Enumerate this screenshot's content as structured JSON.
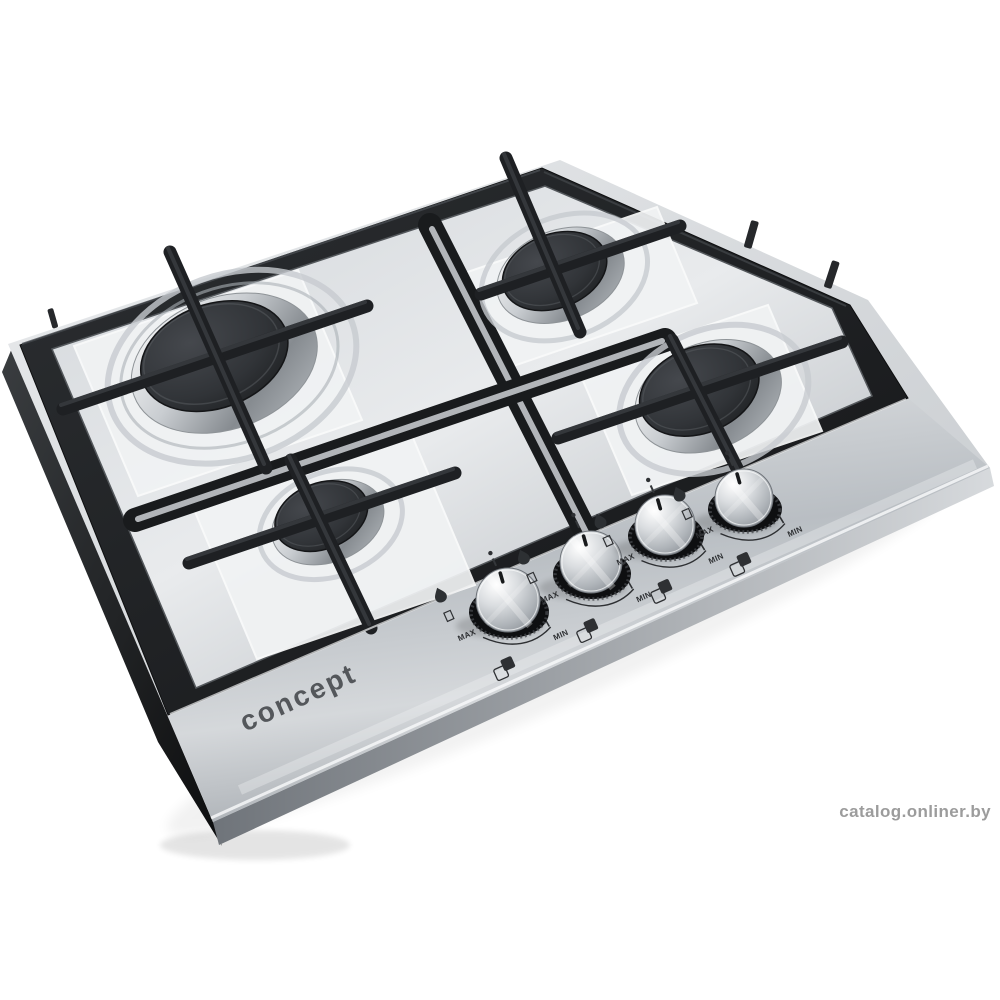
{
  "scene": {
    "background_color": "#ffffff",
    "subject": "Stainless steel four-burner gas hob with black cast-iron pan supports, matte black burner caps and four metal control knobs on the front panel"
  },
  "brand": {
    "logo_text": "concept",
    "logo_color": "#54575b"
  },
  "watermark": {
    "text": "catalog.onliner.by",
    "color": "#9c9c9c"
  },
  "controls": {
    "max_label": "MAX",
    "min_label": "MIN",
    "knobs": [
      {
        "name": "front-left burner knob"
      },
      {
        "name": "rear-left burner knob"
      },
      {
        "name": "rear-right burner knob"
      },
      {
        "name": "front-right burner knob"
      }
    ]
  },
  "burners": [
    {
      "position": "rear-left",
      "size": "large"
    },
    {
      "position": "rear-right",
      "size": "medium"
    },
    {
      "position": "front-right",
      "size": "medium"
    },
    {
      "position": "front-left",
      "size": "small"
    }
  ],
  "colors": {
    "steel_light": "#eef0f2",
    "steel_mid": "#c9cdd1",
    "steel_dark": "#9aa0a6",
    "cast_iron": "#1e2023",
    "burner_cap": "#2f3236",
    "panel": "#c3c8cc"
  }
}
